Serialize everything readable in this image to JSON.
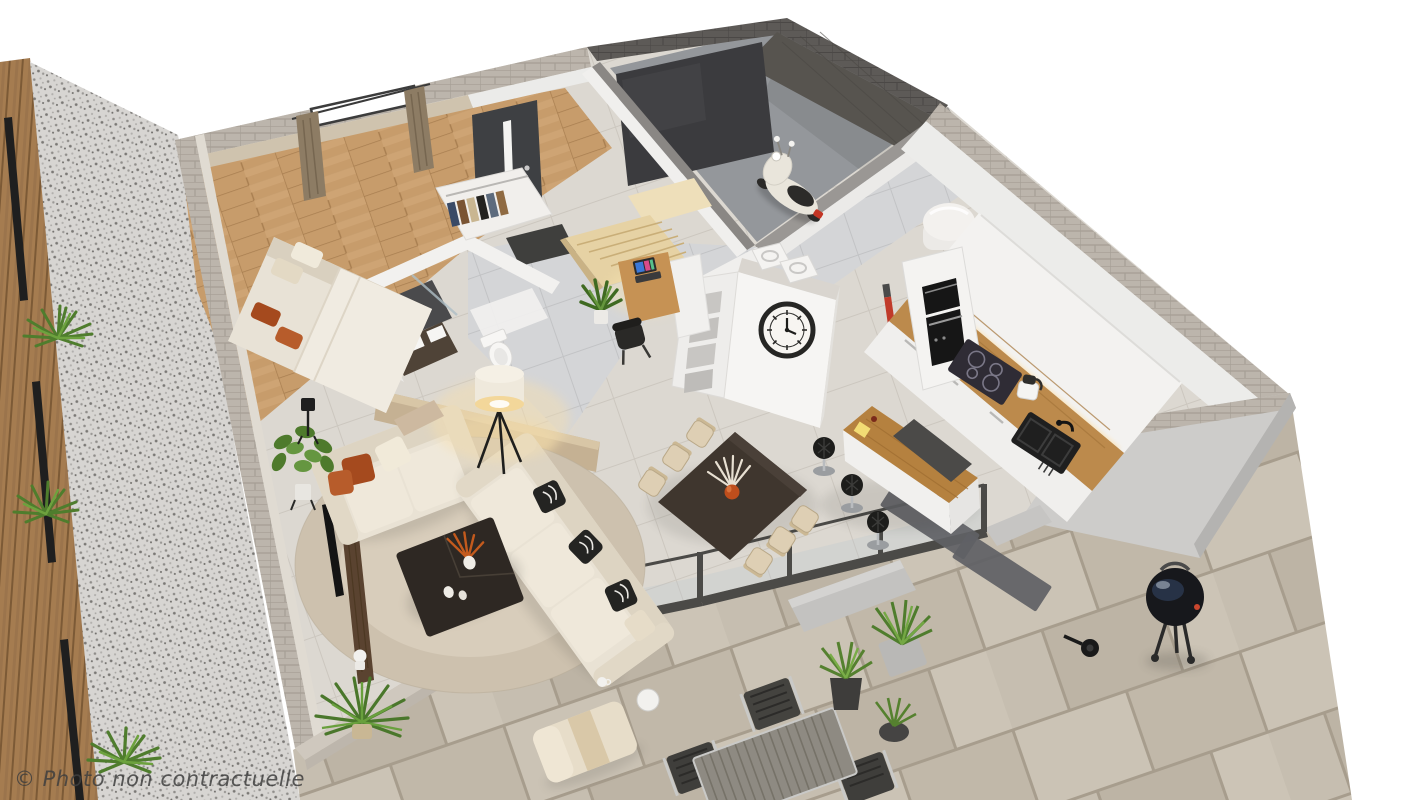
{
  "watermark": {
    "text": "© Photo non contractuelle"
  },
  "palette": {
    "bg": "#ffffff",
    "stone_cap": "#bcb5ac",
    "wall_white": "#ececea",
    "wall_beige": "#cfc3ae",
    "wall_gray": "#cdccca",
    "accent_taupe": "#c5b193",
    "garage_wall": "#5d5a57",
    "garage_door": "#3b3b3e",
    "garage_floor": "#94979b",
    "front_door": "#3e4043",
    "floor_tile": "#dcd8d1",
    "floor_wood": "#c79c6b",
    "hall_tile": "#d4d5d7",
    "terrace_tile": "#c7bfb1",
    "gravel": "#d7d5d2",
    "fence_wood": "#a57c50",
    "glass_frame": "#4b4a47",
    "sofa_cream": "#e9e2d4",
    "pillow_rust": "#a54a1e",
    "pillow_dark": "#242422",
    "rug_beige": "#cdc1ae",
    "coffee_table": "#2e2823",
    "dining_table": "#3f362e",
    "chair_cream": "#decfb4",
    "island_wood": "#b5813f",
    "counter_wood": "#bc8a4c",
    "cabinet_white": "#f3f2f0",
    "appliance_black": "#161616",
    "plant_green": "#55812f",
    "lamp_glow": "#f6dfae",
    "curtain_taupe": "#8d7c64",
    "scooter_cream": "#e9e5db",
    "bbq_black": "#17181c",
    "watermark": "#3f3f3f"
  },
  "scene": {
    "type": "3d-floorplan-render",
    "view": "isometric-cutaway",
    "rooms": [
      {
        "name": "bedroom",
        "objects": [
          "double-bed",
          "orange-cushions",
          "curtained-window",
          "wardrobe",
          "black-floor-lamp"
        ]
      },
      {
        "name": "bathroom",
        "objects": [
          "walk-in-shower",
          "dark-vanity",
          "toilet"
        ]
      },
      {
        "name": "entry",
        "objects": [
          "front-door",
          "doormat",
          "coat-closet",
          "staircase"
        ]
      },
      {
        "name": "office-nook",
        "objects": [
          "wood-desk",
          "laptop",
          "black-chair",
          "potted-plant",
          "cube-shelf",
          "wall-clock"
        ]
      },
      {
        "name": "living-room",
        "objects": [
          "loveseat",
          "corner-sofa",
          "round-rug",
          "dark-coffee-table",
          "tripod-floor-lamp",
          "tv-console",
          "white-bust",
          "plants"
        ]
      },
      {
        "name": "dining-area",
        "objects": [
          "dark-dining-table",
          "six-cream-chairs",
          "orange-vase-pampas"
        ]
      },
      {
        "name": "kitchen",
        "objects": [
          "island-with-bar-stools",
          "white-cabinets",
          "wood-countertop",
          "induction-hob",
          "oven",
          "microwave",
          "black-sink",
          "food-processor",
          "water-heater",
          "stick-vacuum",
          "runner-rugs"
        ]
      },
      {
        "name": "utility",
        "objects": [
          "washer",
          "dryer"
        ]
      },
      {
        "name": "garage",
        "objects": [
          "dark-stone-walls",
          "garage-door",
          "scooter"
        ]
      },
      {
        "name": "terrace",
        "objects": [
          "sliding-glass-doors",
          "outdoor-table",
          "outdoor-chairs",
          "sun-lounger",
          "potted-grasses",
          "kettle-barbecue",
          "stone-tiles"
        ]
      },
      {
        "name": "garden",
        "objects": [
          "gravel-path",
          "grass-tufts",
          "wood-slat-fence"
        ]
      }
    ]
  }
}
